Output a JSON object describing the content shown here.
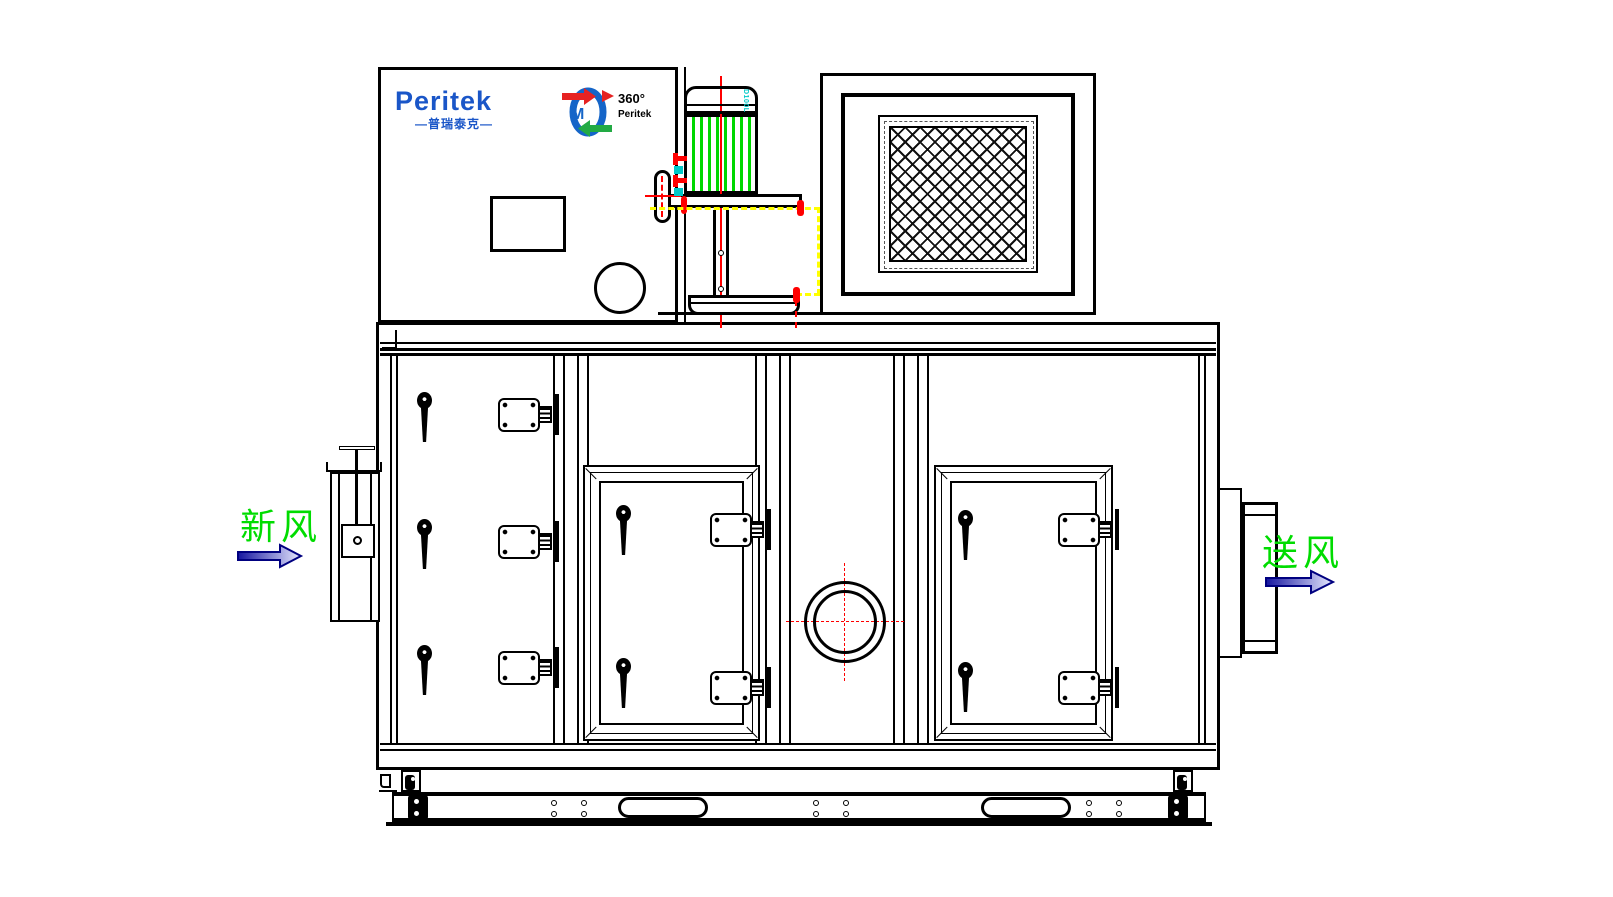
{
  "labels": {
    "fresh_air": "新风",
    "supply_air": "送风"
  },
  "brand": {
    "name": "Peritek",
    "name_cn": "—普瑞泰克—"
  },
  "rotor_logo": {
    "line1": "360°",
    "line2": "Peritek"
  },
  "motor": {
    "frame_label": "D100L"
  },
  "colors": {
    "label_green": "#00DC00",
    "motor_fin_green": "#00D800",
    "centerline_red": "#FF0000",
    "hidden_line_yellow": "#FFFF00",
    "brand_blue": "#1A56C8",
    "accent_cyan": "#00C8C8",
    "rotor_blue": "#1565C8",
    "arrow_gradient_start": "#1515A0",
    "arrow_gradient_end": "#E8EAFF",
    "arrow_outline": "#000080"
  }
}
